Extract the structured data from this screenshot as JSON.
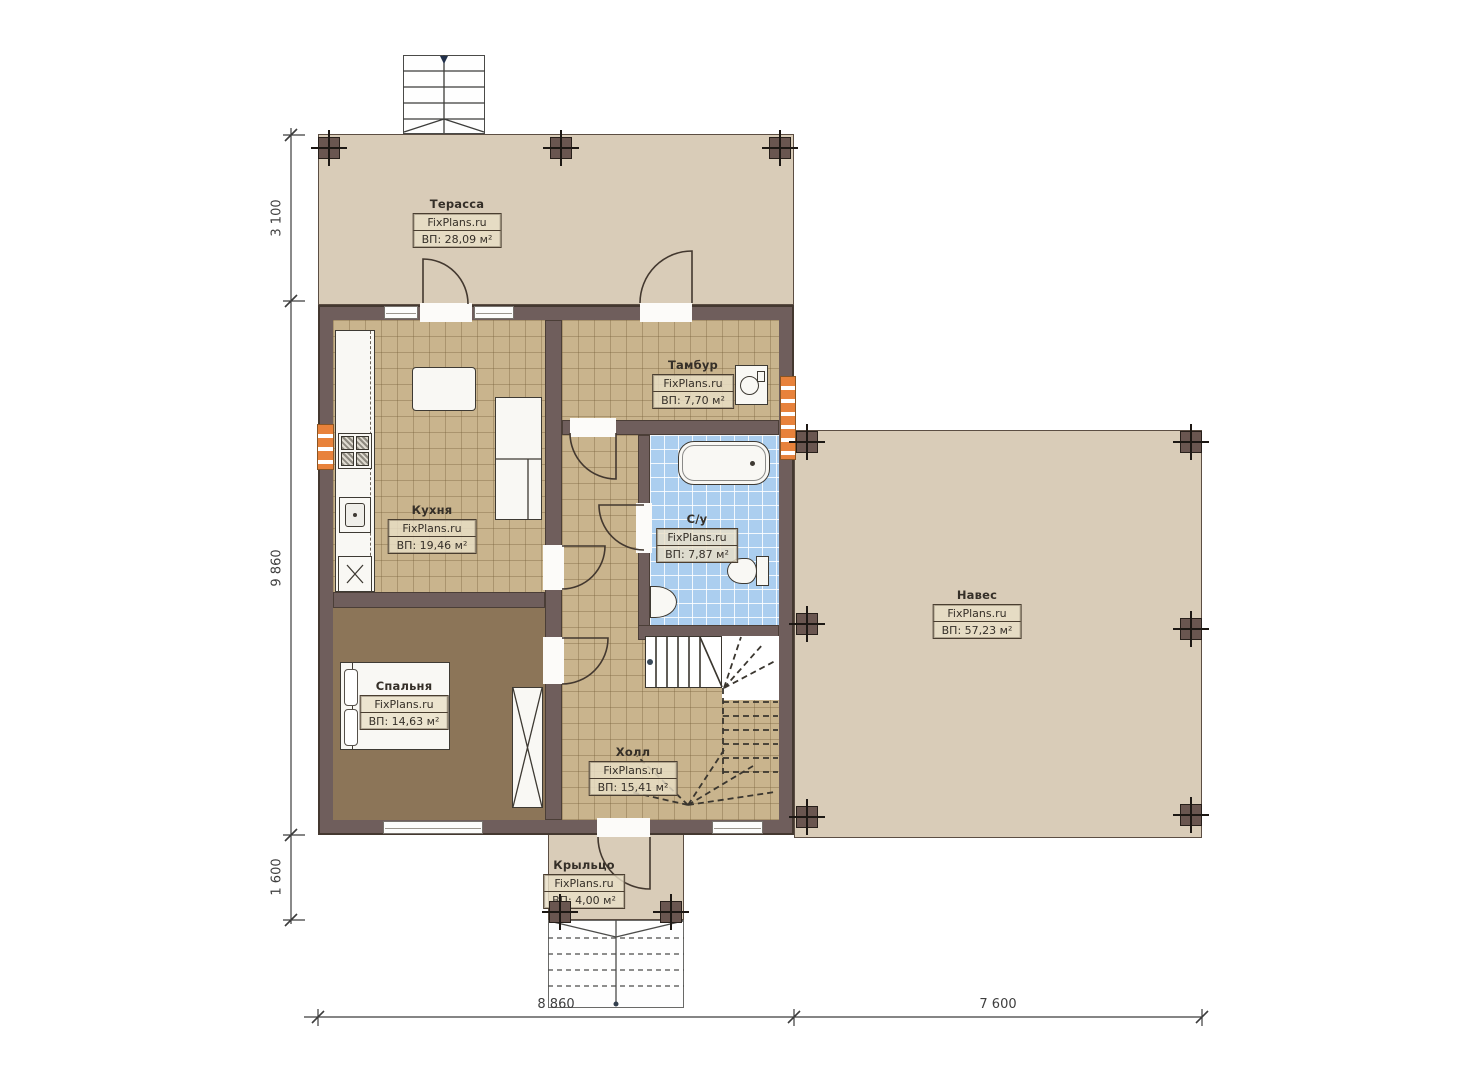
{
  "plan": {
    "rooms": {
      "terrace": {
        "name": "Терасса",
        "brand": "FixPlans.ru",
        "area": "ВП: 28,09 м²"
      },
      "kitchen": {
        "name": "Кухня",
        "brand": "FixPlans.ru",
        "area": "ВП: 19,46 м²"
      },
      "tambour": {
        "name": "Тамбур",
        "brand": "FixPlans.ru",
        "area": "ВП: 7,70 м²"
      },
      "bathroom": {
        "name": "С/у",
        "brand": "FixPlans.ru",
        "area": "ВП: 7,87 м²"
      },
      "canopy": {
        "name": "Навес",
        "brand": "FixPlans.ru",
        "area": "ВП: 57,23 м²"
      },
      "bedroom": {
        "name": "Спальня",
        "brand": "FixPlans.ru",
        "area": "ВП: 14,63 м²"
      },
      "hall": {
        "name": "Холл",
        "brand": "FixPlans.ru",
        "area": "ВП: 15,41 м²"
      },
      "porch": {
        "name": "Крыльцо",
        "brand": "FixPlans.ru",
        "area": "ВП: 4,00 м²"
      }
    },
    "dimensions": {
      "left_top": "3 100",
      "left_middle": "9 860",
      "left_bottom": "1 600",
      "bottom_left": "8 860",
      "bottom_right": "7 600"
    },
    "colors": {
      "wall": "#6f5e5c",
      "outdoor": "#d9ccb8",
      "tile": "#c9b48d",
      "bedroom_floor": "#8c7558",
      "bath_floor": "#abceef",
      "radiator": "#e8823b"
    }
  }
}
